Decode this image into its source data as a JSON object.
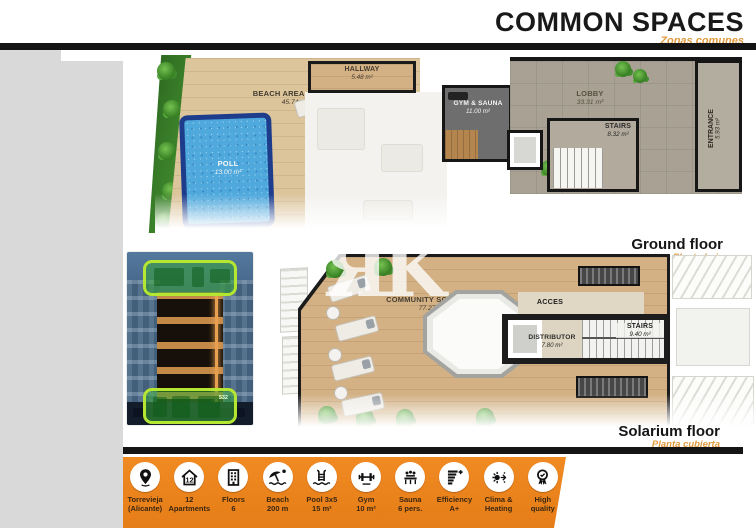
{
  "header": {
    "title": "COMMON SPACES",
    "subtitle": "Zonas comunes"
  },
  "ground_floor": {
    "caption": "Ground floor",
    "caption_es": "Planta baja",
    "rooms": {
      "beach": {
        "name": "BEACH AREA & PATIO",
        "area": "45.74 m²"
      },
      "pool": {
        "name": "POLL",
        "area": "13.00 m²"
      },
      "hallway": {
        "name": "HALLWAY",
        "area": "5.48 m²"
      },
      "gym": {
        "name": "GYM & SAUNA",
        "area": "11.00 m²"
      },
      "lobby": {
        "name": "LOBBY",
        "area": "33.31 m²"
      },
      "stairs": {
        "name": "STAIRS",
        "area": "8.32 m²"
      },
      "entrance": {
        "name": "ENTRANCE",
        "area": "5.93 m²"
      }
    }
  },
  "solarium_floor": {
    "caption": "Solarium floor",
    "caption_es": "Planta cubierta",
    "watermark": "ЯK",
    "rooms": {
      "solarium": {
        "name": "COMMUNITY SOLARIUM",
        "area": "77.27 m²"
      },
      "acces": {
        "name": "ACCES"
      },
      "distributor": {
        "name": "DISTRIBUTOR",
        "area": "7.80 m²"
      },
      "stairs": {
        "name": "STAIRS",
        "area": "9.40 m²"
      }
    }
  },
  "building": {
    "badge": "532"
  },
  "features": [
    {
      "icon": "location-pin-icon",
      "line1": "Torrevieja",
      "line2": "(Alicante)"
    },
    {
      "icon": "apartments-icon",
      "line1": "12",
      "line2": "Apartments"
    },
    {
      "icon": "building-floors-icon",
      "line1": "Floors",
      "line2": "6"
    },
    {
      "icon": "beach-icon",
      "line1": "Beach",
      "line2": "200 m"
    },
    {
      "icon": "pool-icon",
      "line1": "Pool 3x5",
      "line2": "15 m²"
    },
    {
      "icon": "gym-icon",
      "line1": "Gym",
      "line2": "10 m²"
    },
    {
      "icon": "sauna-icon",
      "line1": "Sauna",
      "line2": "6 pers."
    },
    {
      "icon": "efficiency-icon",
      "line1": "Efficiency",
      "line2": "A+"
    },
    {
      "icon": "climate-icon",
      "line1": "Clima &",
      "line2": "Heating"
    },
    {
      "icon": "quality-icon",
      "line1": "High",
      "line2": "quality"
    }
  ],
  "colors": {
    "accent_orange": "#e8821f",
    "subtitle_orange": "#e09a3e",
    "highlight_green": "#b5e632",
    "pool_blue": "#4fa9dc",
    "wall_black": "#161616",
    "wood": "#d8bb90",
    "sidebar_gray": "#d9d9d9"
  }
}
